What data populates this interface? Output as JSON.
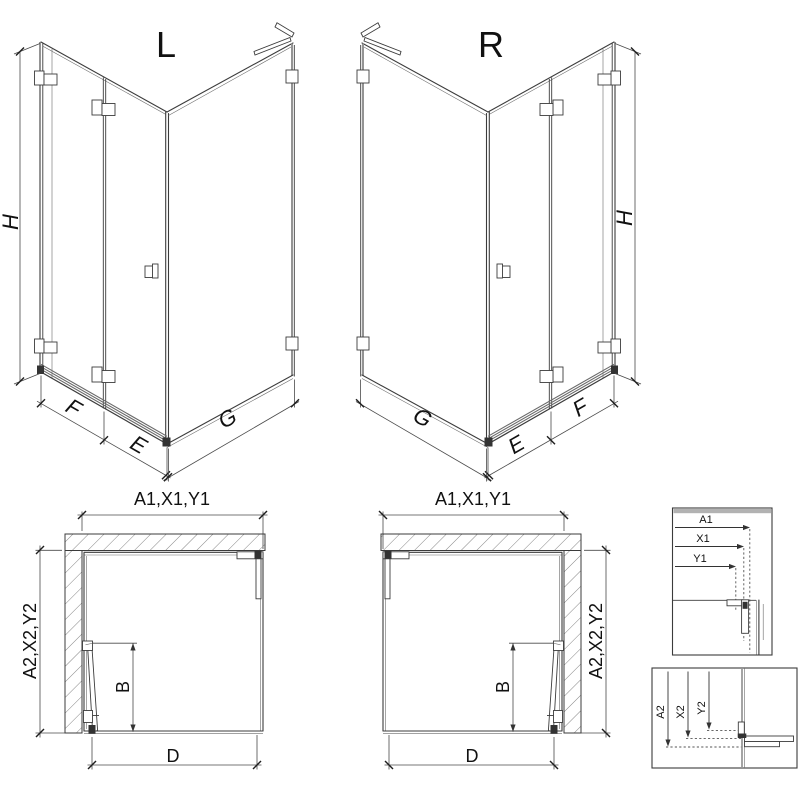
{
  "colors": {
    "line": "#3c3c3c",
    "profile_gray": "#949494",
    "hatch": "#777777",
    "wall_band": "#b2b2b2",
    "text": "#111111",
    "background": "#ffffff"
  },
  "iso_left": {
    "title": "L",
    "dim_height": "H",
    "dim_front_door": "F",
    "dim_front_fixed": "E",
    "dim_side": "G"
  },
  "iso_right": {
    "title": "R",
    "dim_height": "H",
    "dim_front_door": "F",
    "dim_front_fixed": "E",
    "dim_side": "G"
  },
  "plan_left": {
    "dim_width": "A1,X1,Y1",
    "dim_depth": "A2,X2,Y2",
    "dim_door": "B",
    "dim_entry": "D"
  },
  "plan_right": {
    "dim_width": "A1,X1,Y1",
    "dim_depth": "A2,X2,Y2",
    "dim_door": "B",
    "dim_entry": "D"
  },
  "detail_width": {
    "dim_a": "A1",
    "dim_x": "X1",
    "dim_y": "Y1"
  },
  "detail_depth": {
    "dim_a": "A2",
    "dim_x": "X2",
    "dim_y": "Y2"
  }
}
